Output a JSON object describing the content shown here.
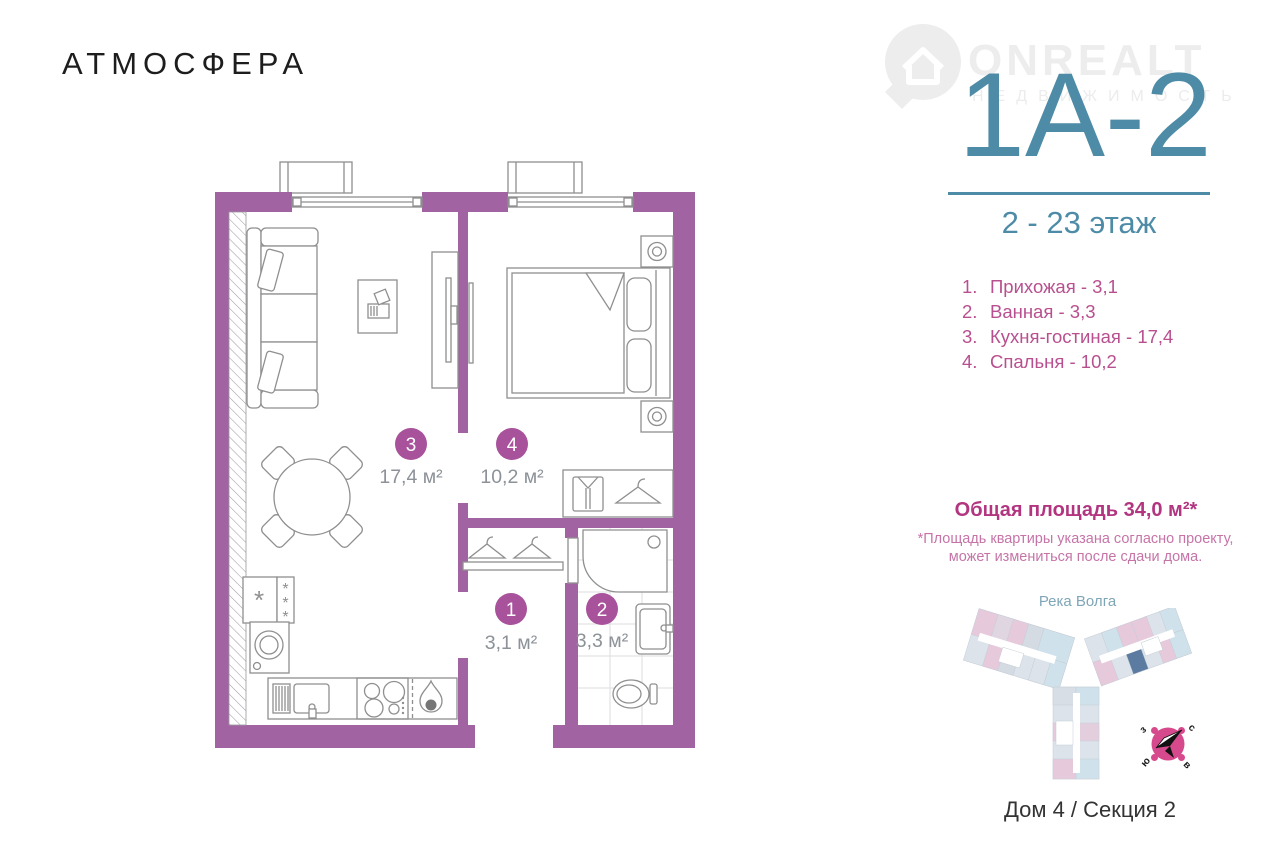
{
  "brand_logo": "АТМОСФЕРА",
  "watermark": {
    "name": "ONREALT",
    "subtitle": "НЕДВИЖИМОСТЬ"
  },
  "unit": {
    "code": "1А-2",
    "floors": "2 - 23 этаж"
  },
  "room_list": [
    {
      "num": "1.",
      "label": "Прихожая - 3,1"
    },
    {
      "num": "2.",
      "label": "Ванная - 3,3"
    },
    {
      "num": "3.",
      "label": "Кухня-гостиная - 17,4"
    },
    {
      "num": "4.",
      "label": "Спальня - 10,2"
    }
  ],
  "total_area": {
    "title": "Общая площадь 34,0 м²*",
    "note_line1": "*Площадь квартиры указана согласно проекту,",
    "note_line2": "может измениться после сдачи дома."
  },
  "plan_labels": {
    "room3": {
      "num": "3",
      "area": "17,4 м²"
    },
    "room4": {
      "num": "4",
      "area": "10,2 м²"
    },
    "room1": {
      "num": "1",
      "area": "3,1 м²"
    },
    "room2": {
      "num": "2",
      "area": "3,3 м²"
    }
  },
  "site_plan": {
    "river": "Река Волга",
    "caption": "Дом 4 / Секция 2",
    "compass": {
      "north": "с",
      "south": "ю",
      "west": "з",
      "east": "в"
    }
  },
  "colors": {
    "wall_purple": "#a263a2",
    "badge_purple": "#a8529c",
    "accent_teal": "#4e8ba6",
    "list_pink": "#b8508f",
    "total_pink": "#b23580",
    "note_pink": "#c674a8",
    "compass_pink": "#d6498c",
    "highlighted_unit_blue": "#5b7ba1"
  }
}
